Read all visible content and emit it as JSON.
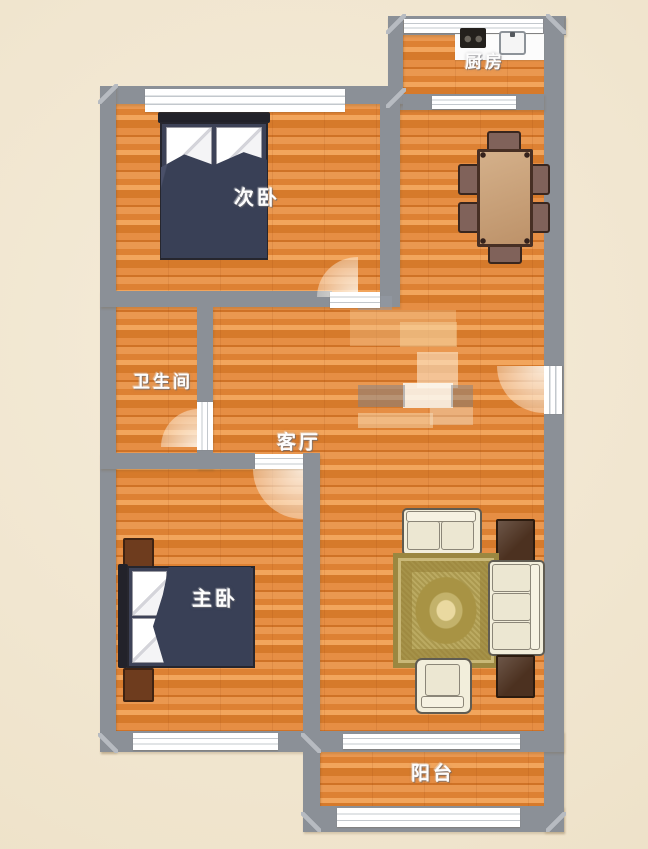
{
  "plan": {
    "type": "apartment-floor-plan",
    "rooms": {
      "kitchen": {
        "label": "厨房"
      },
      "secondary_bedroom": {
        "label": "次卧"
      },
      "bathroom": {
        "label": "卫生间"
      },
      "living_room": {
        "label": "客厅"
      },
      "master_bedroom": {
        "label": "主卧"
      },
      "balcony": {
        "label": "阳台"
      }
    },
    "furniture": [
      "secondary-bedroom-double-bed",
      "dining-table-with-six-chairs",
      "kitchen-counter-with-stove-and-sink",
      "master-bedroom-double-bed",
      "two-nightstands",
      "loveseat-sofa",
      "three-seat-sofa",
      "armchair",
      "two-dark-side-tables",
      "gold-area-rug"
    ],
    "colors": {
      "background": "#f2e8d4",
      "wall": "#8b9097",
      "floor_light": "#eb9b52",
      "floor_dark": "#d47b2c",
      "bed_duvet": "#3c4156",
      "sofa_cream": "#f2eedb",
      "rug_gold": "#b3a052",
      "table_wood": "#c8a078",
      "dark_wood": "#4c3120",
      "window_white": "#ffffff",
      "label_text": "#ffffff"
    }
  }
}
